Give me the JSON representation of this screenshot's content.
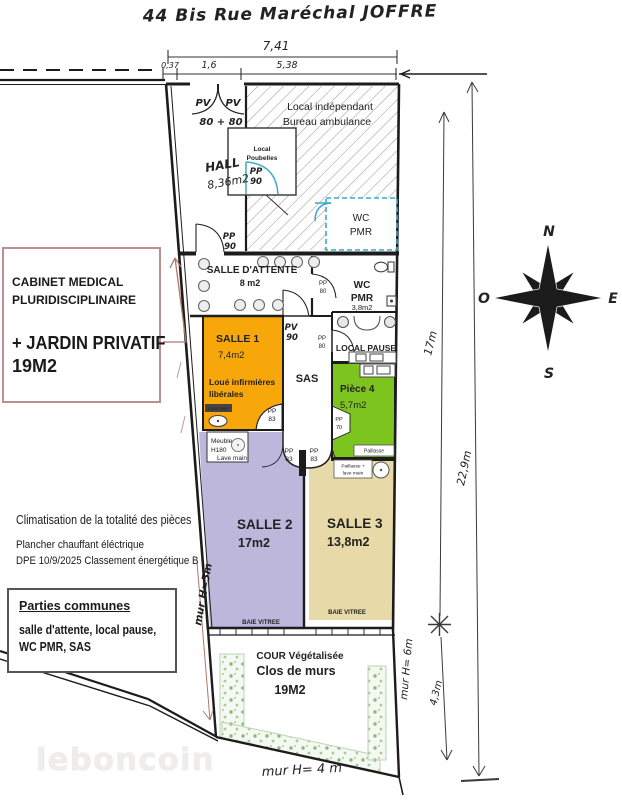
{
  "title": "44 Bis Rue Maréchal JOFFRE",
  "watermark": "leboncoin",
  "compass": {
    "n": "N",
    "e": "E",
    "s": "S",
    "o": "O"
  },
  "top_dimensions": {
    "total": "7,41",
    "seg1": "0,37",
    "seg2": "1,6",
    "seg3": "5,38"
  },
  "side_dimensions": {
    "inner_upper": "17m",
    "outer": "22,9m",
    "inner_lower": "4,3m"
  },
  "wall_heights": {
    "left": "mur H=5m",
    "right": "mur H= 6m",
    "bottom": "mur H= 4 m"
  },
  "left_panel": {
    "cabinet_line1": "CABINET MEDICAL",
    "cabinet_line2": "PLURIDISCIPLINAIRE",
    "cabinet_line3": "+ JARDIN PRIVATIF",
    "cabinet_line4": "19M2",
    "climate": "Climatisation de la totalité des pièces",
    "heating": "Plancher chauffant éléctrique",
    "dpe": "DPE 10/9/2025 Classement énergétique B",
    "common_title": "Parties communes",
    "common_line1": "salle d'attente, local pause,",
    "common_line2": "WC PMR, SAS"
  },
  "rooms": {
    "hall_name": "HALL",
    "hall_area": "8,36m2",
    "independant_line1": "Local indépendant",
    "independant_line2": "Bureau ambulance",
    "poubelles_line1": "Local",
    "poubelles_line2": "Poubelles",
    "wc": "WC",
    "pmr": "PMR",
    "wc_pmr_area": "3,8m2",
    "attente_name": "SALLE D'ATTENTE",
    "attente_area": "8 m2",
    "pause_name": "LOCAL PAUSE",
    "salle1_name": "SALLE 1",
    "salle1_area": "7,4m2",
    "salle1_note1": "Loué infirmières",
    "salle1_note2": "libérales",
    "sas": "SAS",
    "piece4_name": "Pièce 4",
    "piece4_area": "5,7m2",
    "salle2_name": "SALLE 2",
    "salle2_area": "17m2",
    "salle3_name": "SALLE 3",
    "salle3_area": "13,8m2",
    "cour_line1": "COUR Végétalisée",
    "cour_line2": "Clos de murs",
    "cour_area": "19M2"
  },
  "fixtures": {
    "pv": "PV",
    "pp": "PP",
    "n70": "70",
    "n80": "80",
    "n83": "83",
    "n90": "90",
    "entry_width": "80 + 80",
    "baie": "BAIE VITREE",
    "lave_main": "Lave main",
    "meuble_line1": "Meuble",
    "meuble_line2": "H180",
    "paillasse": "Paillasse",
    "paillasse_lave1": "Paillasse +",
    "paillasse_lave2": "lave main"
  },
  "colors": {
    "salle1": "#F7A70A",
    "salle2": "#BDB7DB",
    "salle3": "#E7D9A8",
    "piece4": "#7DC41E",
    "blue": "#3FA8C9",
    "red": "#B0756B"
  }
}
